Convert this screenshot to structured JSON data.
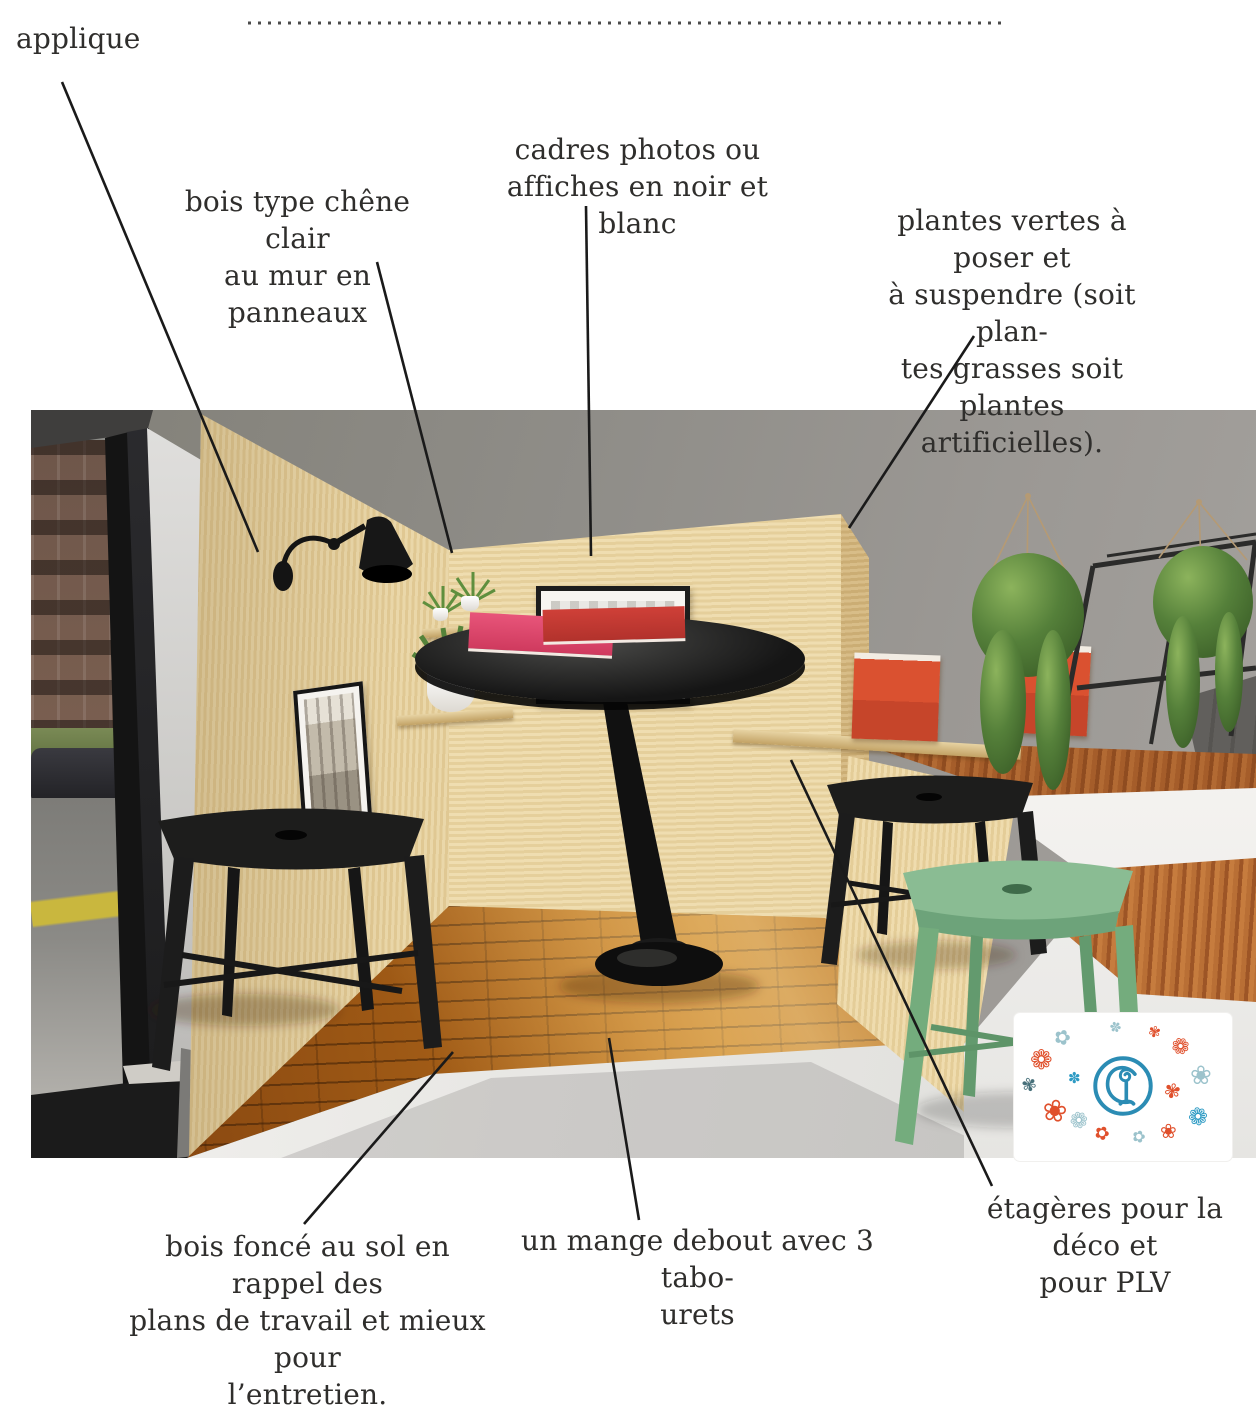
{
  "annotations": {
    "applique": "applique",
    "wall_wood": "bois type chêne clair\nau mur en panneaux",
    "frames": "cadres photos ou\naffiches en noir et blanc",
    "plants": "plantes vertes à poser et\nà suspendre (soit plan-\ntes grasses soit plantes\nartificielles).",
    "floor": "bois foncé au sol en rappel des\nplans de travail et mieux pour\nl’entretien.",
    "table": "un mange debout avec 3 tabo-\nurets",
    "shelves": "étagères pour la déco et\npour PLV"
  },
  "scene": {
    "license_plate": "EW664FX"
  },
  "logo": {
    "monogram_letters": "CL",
    "flowers": {
      "daisy": "❁",
      "blossom": "✿",
      "petal": "✾",
      "bloom": "❀",
      "spark": "✽"
    }
  },
  "colors": {
    "oak_wall": "#e5d0a0",
    "walnut_counter": "#a55d2a",
    "dark_floor": "#a55f17",
    "green_stool": "#7cb287",
    "logo_blue": "#2b8cb4",
    "logo_orange": "#e0502c",
    "book_red": "#d84e2a"
  }
}
